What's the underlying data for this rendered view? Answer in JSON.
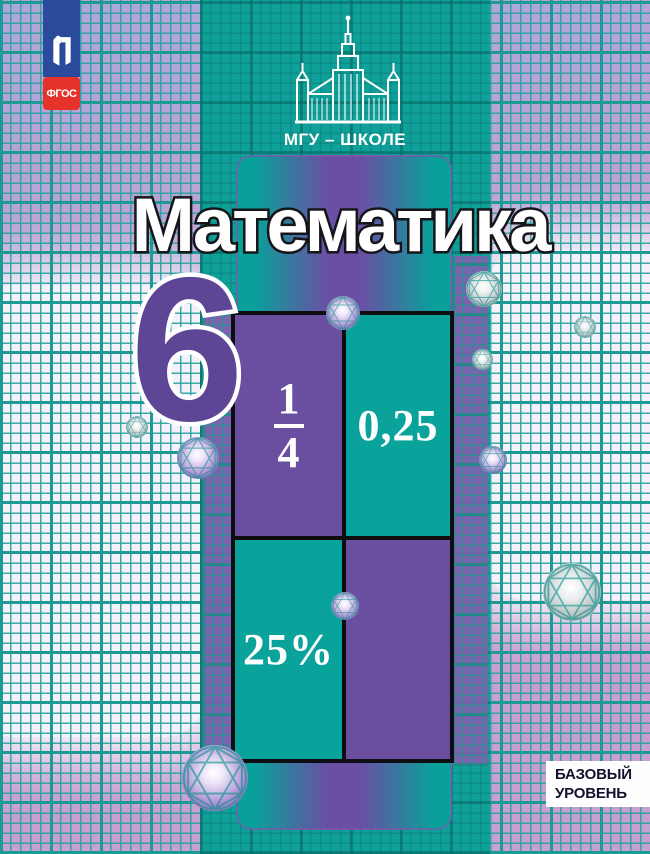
{
  "title": "Математика",
  "grade": "6",
  "banner": {
    "label": "МГУ – ШКОЛЕ"
  },
  "badges": {
    "publisher_icon": "prosveshchenie-logo",
    "fgos": "ФГОС"
  },
  "level": {
    "line1": "БАЗОВЫЙ",
    "line2": "УРОВЕНЬ"
  },
  "table": {
    "fraction": {
      "numerator": "1",
      "denominator": "4"
    },
    "decimal": "0,25",
    "percent": "25%"
  },
  "icons": {
    "university": "mgu-building",
    "decor": "molecule-sphere"
  },
  "colors": {
    "band_teal": "#0fa09a",
    "grid_lavender": "#c0a2d3",
    "grid_line_teal": "#1c9a93",
    "cell_purple": "#6a4fa0",
    "cell_teal": "#0aa39c",
    "grade_purple": "#5e4697",
    "badge_blue": "#2a4b9c",
    "badge_red": "#e5322b",
    "level_text": "#12122e",
    "title_fill": "#ffffff",
    "title_outline": "#15151a"
  }
}
